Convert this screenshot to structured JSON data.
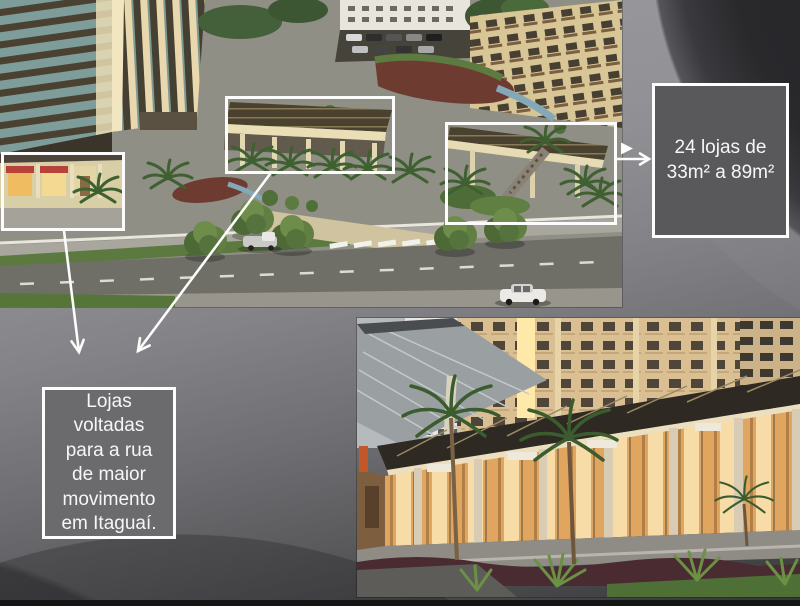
{
  "callouts": {
    "left": {
      "text": "Lojas\nvoltadas\npara a rua\nde maior\nmovimento\nem Itaguaí."
    },
    "right": {
      "text": "24 lojas de\n33m² a 89m²"
    }
  },
  "colors": {
    "annotation_white": "#fcfcfc",
    "callout_border": "#fdfdfd",
    "callout_text": "#f6f6f6",
    "callout_fill_left": "#6b6b6d",
    "callout_fill_right": "#59595b",
    "background_top_right": "#29292c",
    "background_mid_gray": "#848488",
    "background_bottom": "#353537",
    "bottom_bar": "#151515"
  }
}
